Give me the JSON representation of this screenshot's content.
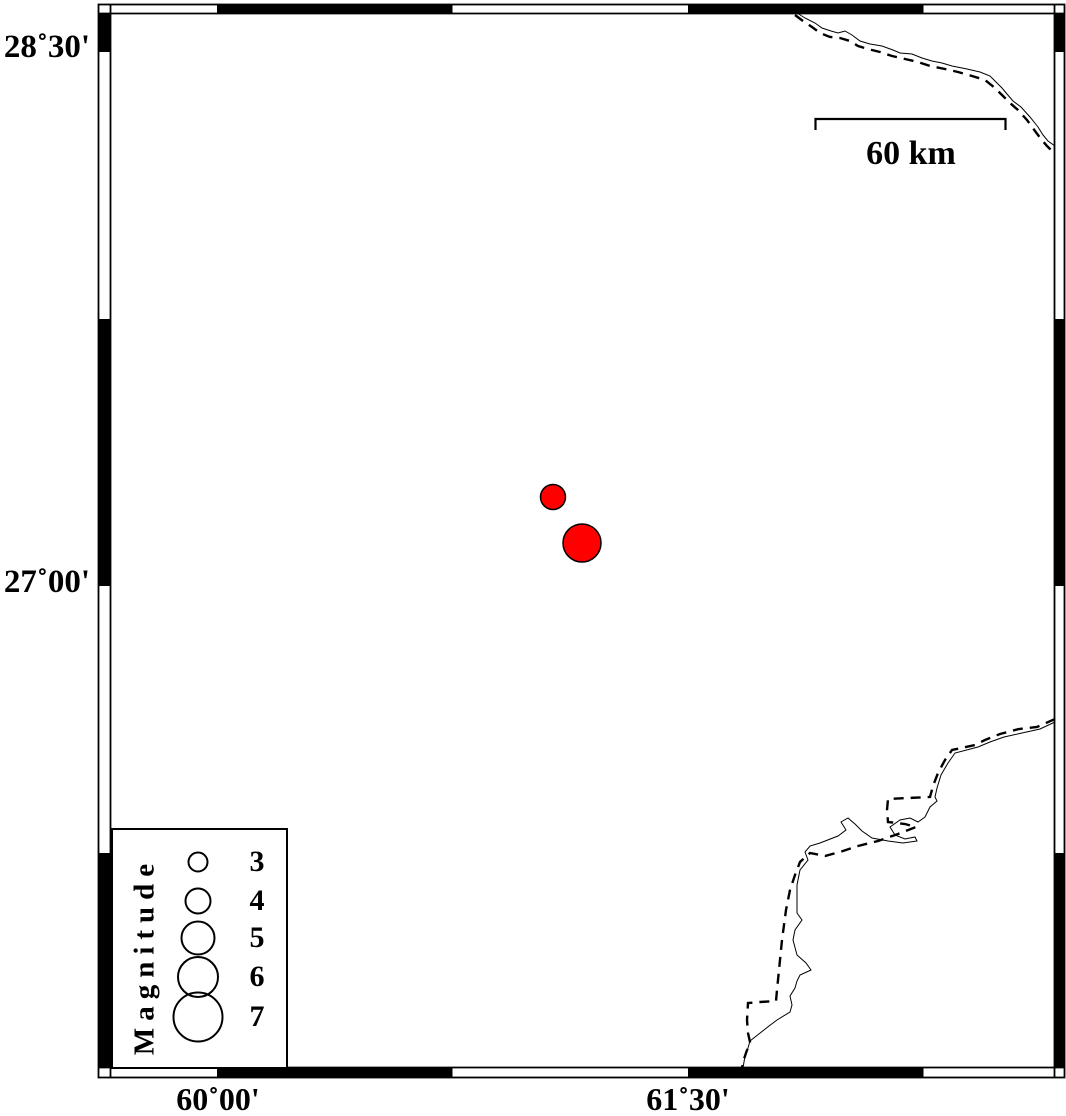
{
  "map": {
    "background": "#ffffff",
    "frame": {
      "style": "fancy alternating black/white border, tick interval 45 minutes",
      "lat_labels": [
        {
          "text": "28˚30'",
          "y_px": 52
        },
        {
          "text": "27˚00'",
          "y_px": 586
        }
      ],
      "lon_labels": [
        {
          "text": "60˚00'",
          "x_px": 217
        },
        {
          "text": "61˚30'",
          "x_px": 688
        }
      ]
    },
    "scale_bar": {
      "label": "60 km",
      "length_km": 60,
      "length_px": 190
    },
    "legend": {
      "title": "Magnitude",
      "entries": [
        {
          "label": "3",
          "diameter_px": 21,
          "center_y_in_box_px": 32
        },
        {
          "label": "4",
          "diameter_px": 27,
          "center_y_in_box_px": 71
        },
        {
          "label": "5",
          "diameter_px": 35,
          "center_y_in_box_px": 108
        },
        {
          "label": "6",
          "diameter_px": 42,
          "center_y_in_box_px": 147
        },
        {
          "label": "7",
          "diameter_px": 51,
          "center_y_in_box_px": 187
        }
      ]
    },
    "epicenters": [
      {
        "x_px": 553,
        "y_px": 497,
        "diameter_px": 25,
        "approx_magnitude": 3.7,
        "approx_lon": "61°04'E",
        "approx_lat": "27°15'N",
        "fill": "#ff0000"
      },
      {
        "x_px": 582,
        "y_px": 543,
        "diameter_px": 38,
        "approx_magnitude": 5.4,
        "approx_lon": "61°10'E",
        "approx_lat": "27°07'N",
        "fill": "#ff0000"
      }
    ],
    "colors": {
      "epicenter_fill": "#ff0000",
      "line": "#000000",
      "background": "#ffffff"
    }
  },
  "chart_data": {
    "type": "scatter",
    "title": "Epicenter map with magnitude-scaled symbols",
    "xlabel": "Longitude",
    "ylabel": "Latitude",
    "x_ticks": [
      "60˚00'",
      "61˚30'"
    ],
    "y_ticks": [
      "28˚30'",
      "27˚00'"
    ],
    "grid": false,
    "legend_position": "bottom-left",
    "legend_title": "Magnitude",
    "legend_values": [
      3,
      4,
      5,
      6,
      7
    ],
    "series": [
      {
        "name": "epicenters",
        "points": [
          {
            "lon_deg": 61.07,
            "lat_deg": 27.25,
            "magnitude": 3.7
          },
          {
            "lon_deg": 61.16,
            "lat_deg": 27.12,
            "magnitude": 5.4
          }
        ]
      }
    ],
    "annotations": [
      "60 km scale bar",
      "dashed international border with thin coastline/river lines in NE and SE corners"
    ]
  }
}
